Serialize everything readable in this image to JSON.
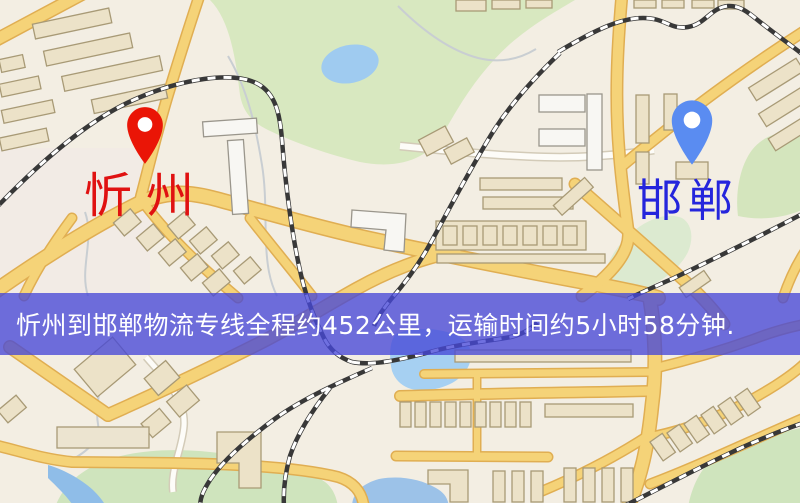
{
  "map": {
    "markers": {
      "origin": {
        "name": "忻州",
        "pin_color": "#ea1506",
        "label_color": "#e01111"
      },
      "destination": {
        "name": "邯郸",
        "pin_color": "#5a8cf1",
        "label_color": "#2525dc"
      }
    },
    "banner": {
      "text": "忻州到邯郸物流专线全程约452公里，运输时间约5小时58分钟.",
      "background": "rgba(70,72,215,0.78)",
      "text_color": "#ffffff"
    },
    "route": {
      "distance_km": "452",
      "duration": "5小时58分钟"
    },
    "theme": {
      "background": "#f3eee3",
      "road_color": "#f5d378",
      "road_casing": "#e0ae52",
      "railway_color": "#383838",
      "water_color": "#a6d0f2",
      "park_color": "#d8e8c2",
      "building_color": "#ece2c8"
    }
  }
}
